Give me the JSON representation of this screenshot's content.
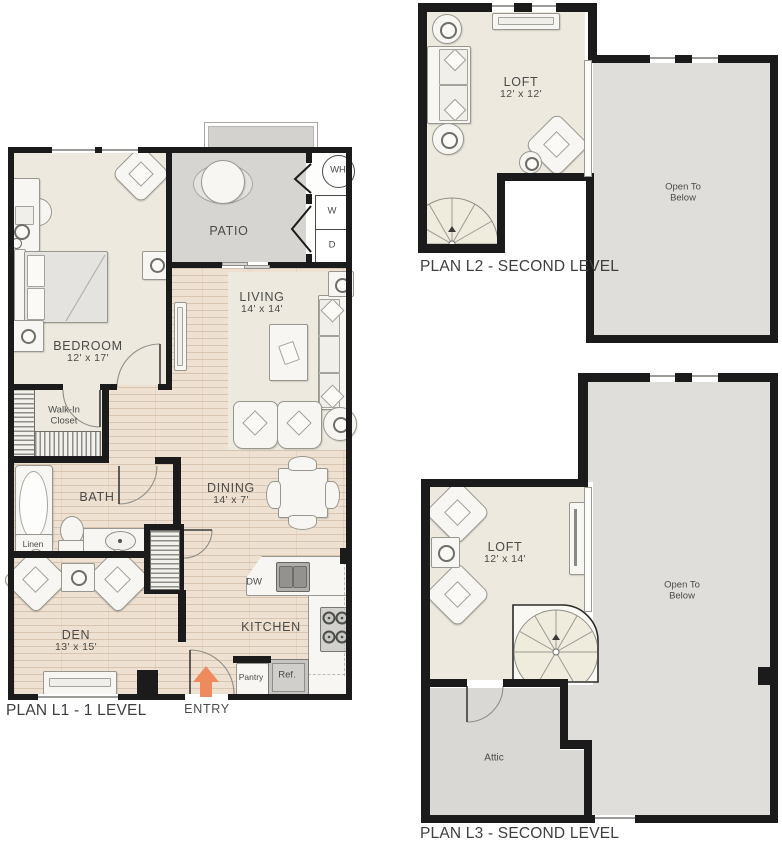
{
  "l1": {
    "title": "PLAN L1 - 1 LEVEL",
    "bedroom": {
      "name": "BEDROOM",
      "dims": "12' x 17'"
    },
    "patio": {
      "name": "PATIO"
    },
    "living": {
      "name": "LIVING",
      "dims": "14' x 14'"
    },
    "dining": {
      "name": "DINING",
      "dims": "14' x 7'"
    },
    "bath": {
      "name": "BATH"
    },
    "walk_in_closet": {
      "line1": "Walk-In",
      "line2": "Closet"
    },
    "linen": {
      "name": "Linen"
    },
    "den": {
      "name": "DEN",
      "dims": "13' x 15'"
    },
    "kitchen": {
      "name": "KITCHEN"
    },
    "pantry": {
      "name": "Pantry"
    },
    "fridge": {
      "name": "Ref."
    },
    "dishwasher": {
      "name": "DW"
    },
    "water_heater": {
      "name": "WH"
    },
    "washer": {
      "name": "W"
    },
    "dryer": {
      "name": "D"
    },
    "entry": {
      "name": "ENTRY"
    }
  },
  "l2": {
    "title": "PLAN L2 - SECOND LEVEL",
    "loft": {
      "name": "LOFT",
      "dims": "12' x 12'"
    },
    "open_to_below": {
      "line1": "Open To",
      "line2": "Below"
    }
  },
  "l3": {
    "title": "PLAN L3 - SECOND LEVEL",
    "loft": {
      "name": "LOFT",
      "dims": "12' x 14'"
    },
    "open_to_below": {
      "line1": "Open To",
      "line2": "Below"
    },
    "attic": {
      "name": "Attic"
    }
  },
  "colors": {
    "wall": "#1b1b1b",
    "room_floor": "#ede9de",
    "wood_floor": "#eee1d1",
    "patio_floor": "#d6d5d2",
    "open_below_floor": "#dfdedb",
    "attic_floor": "#d9d8d5",
    "entry_arrow": "#ef8a5f"
  }
}
